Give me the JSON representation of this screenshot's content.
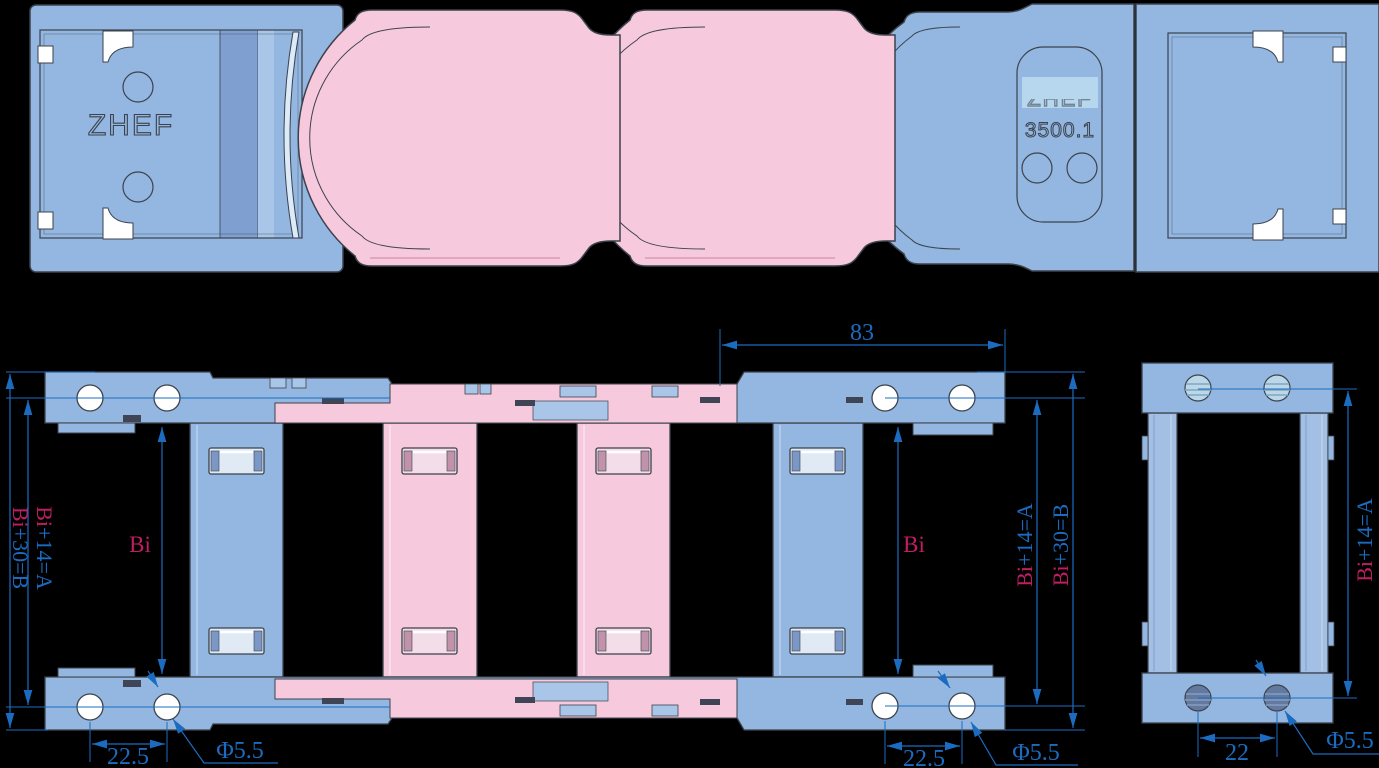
{
  "drawing": {
    "type": "engineering-drawing",
    "subject": "cable drag chain",
    "brand": "ZHEF",
    "model": "3500.1",
    "faded_brand": "ZHEF"
  },
  "dims": {
    "pitch": "83",
    "bi": "Bi",
    "a_suffix": "+14=A",
    "b_suffix": "+30=B",
    "side_hole_spacing": "22.5",
    "end_hole_spacing": "22",
    "hole_diameter": "Φ5.5"
  },
  "colors": {
    "background": "#000000",
    "part_blue": "#93b7e0",
    "part_blue_light": "#a9c6e8",
    "part_blue_dark": "#7e9fd0",
    "part_pink": "#f7c9dc",
    "part_pink_dark": "#c193ab",
    "outline": "#3c424d",
    "dimension_blue": "#1b6cc0",
    "dimension_crimson": "#c01d63",
    "badge_highlight": "#b7d7ee"
  }
}
